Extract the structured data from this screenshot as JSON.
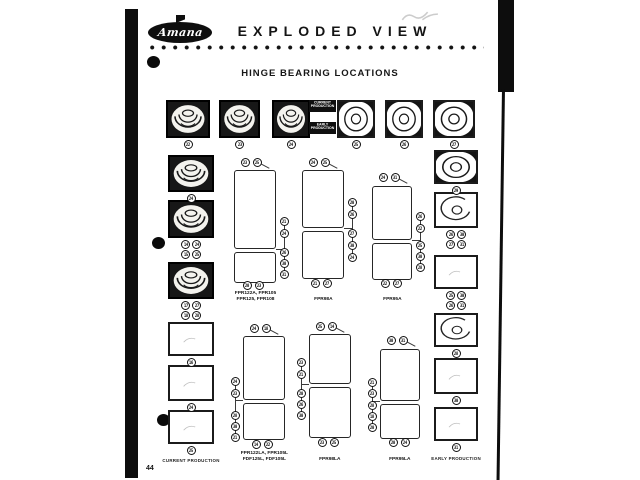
{
  "page": {
    "number": "44"
  },
  "header": {
    "brand": "Amana",
    "title": "EXPLODED VIEW",
    "section_title": "HINGE BEARING LOCATIONS"
  },
  "production_tags": {
    "current": "CURRENT PRODUCTION",
    "early": "EARLY PRODUCTION"
  },
  "footer_labels": {
    "left": "CURRENT PRODUCTION",
    "right": "EARLY PRODUCTION"
  },
  "top_row_boxes": [
    {
      "style": "cup-dark",
      "callout": "22"
    },
    {
      "style": "cup-dark",
      "callout": "23"
    },
    {
      "style": "cup-dark",
      "callout": "24"
    },
    {
      "style": "ring-dark",
      "callout": "25"
    },
    {
      "style": "ring-dark",
      "callout": "26"
    },
    {
      "style": "ring-dark",
      "callout": "27"
    }
  ],
  "left_column_boxes": [
    {
      "style": "cup-dark",
      "callouts": [
        "24"
      ]
    },
    {
      "style": "cup-dark",
      "callouts": [
        "14",
        "24",
        "15",
        "25"
      ]
    },
    {
      "style": "cup-dark",
      "callouts": [
        "17",
        "27",
        "18",
        "28"
      ]
    },
    {
      "style": "plain",
      "callouts": [
        "16"
      ]
    },
    {
      "style": "plain",
      "callouts": [
        "24"
      ]
    },
    {
      "style": "plain",
      "callouts": [
        "25"
      ]
    }
  ],
  "right_column_boxes": [
    {
      "style": "ring-dark",
      "callouts": [
        "29"
      ]
    },
    {
      "style": "arc",
      "callouts": [
        "26",
        "30",
        "27",
        "31"
      ]
    },
    {
      "style": "plain",
      "callouts": [
        "25",
        "30",
        "26",
        "31"
      ]
    },
    {
      "style": "arc",
      "callouts": [
        "28"
      ]
    },
    {
      "style": "plain",
      "callouts": [
        "30"
      ]
    },
    {
      "style": "plain",
      "callouts": [
        "31"
      ]
    }
  ],
  "refrigerators": [
    {
      "model_lines": [
        "FPR122A, FPR105",
        "FPR125, FPR108"
      ],
      "top": [
        "23",
        "25"
      ],
      "side": [
        "21",
        "24",
        "26",
        "30",
        "31"
      ],
      "bottom": [
        "20",
        "23"
      ]
    },
    {
      "model_lines": [
        "FPR98A"
      ],
      "top": [
        "24",
        "25"
      ],
      "side": [
        "20",
        "26",
        "27",
        "30",
        "24"
      ],
      "bottom": [
        "21",
        "27"
      ]
    },
    {
      "model_lines": [
        "FPR95A"
      ],
      "top": [
        "24",
        "31"
      ],
      "side": [
        "26",
        "22",
        "25",
        "30",
        "28"
      ],
      "bottom": [
        "22",
        "27"
      ]
    },
    {
      "model_lines": [
        "FPR122LA, FPR105L",
        "FDF125L, FDF105L"
      ],
      "top": [
        "24",
        "18"
      ],
      "side": [
        "24",
        "23",
        "28",
        "30",
        "21"
      ],
      "bottom": [
        "14",
        "22"
      ]
    },
    {
      "model_lines": [
        "FPR98LA"
      ],
      "top": [
        "25",
        "14"
      ],
      "side": [
        "23",
        "21",
        "20",
        "26",
        "30"
      ],
      "bottom": [
        "23",
        "25"
      ]
    },
    {
      "model_lines": [
        "FPR95LA"
      ],
      "top": [
        "30",
        "31"
      ],
      "side": [
        "21",
        "23",
        "28",
        "18",
        "20"
      ],
      "bottom": [
        "20",
        "24"
      ]
    }
  ]
}
